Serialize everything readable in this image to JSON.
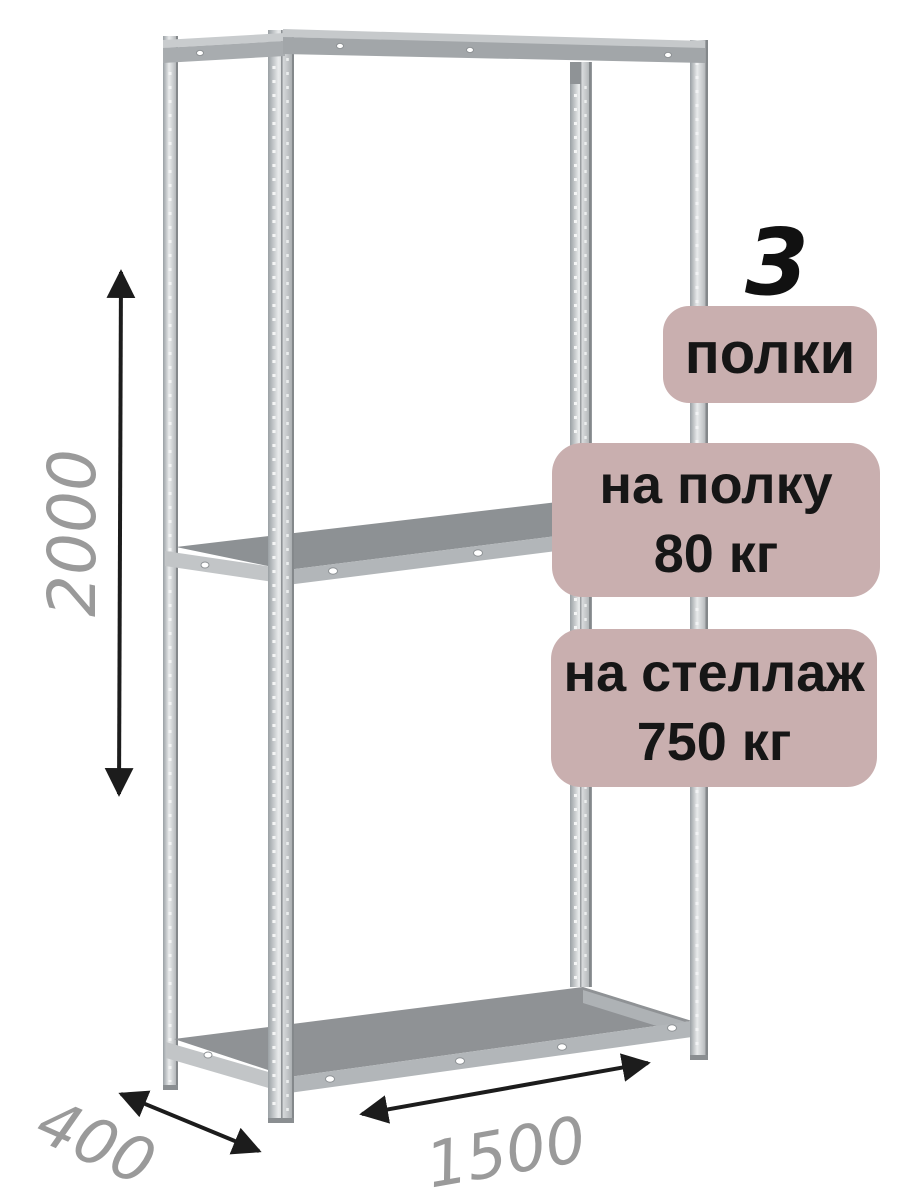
{
  "canvas": {
    "width": 900,
    "height": 1200,
    "background": "#ffffff"
  },
  "headline": {
    "shelf_count": "3"
  },
  "badges": {
    "bg_color": "#c9afaf",
    "text_color": "#161616",
    "items": [
      {
        "lines": [
          "полки"
        ]
      },
      {
        "lines": [
          "на полку",
          "80 кг"
        ]
      },
      {
        "lines": [
          "на стеллаж",
          "750 кг"
        ]
      }
    ]
  },
  "dimensions": {
    "label_color": "#9a9a9a",
    "arrow_color": "#1c1c1c",
    "height": "2000",
    "depth": "400",
    "width": "1500"
  },
  "illustration": {
    "subject": "metal-shelving-rack-with-3-shelves",
    "metal_light": "#e6e8e9",
    "metal_mid": "#b2b6b9",
    "metal_dark": "#8f9295"
  }
}
